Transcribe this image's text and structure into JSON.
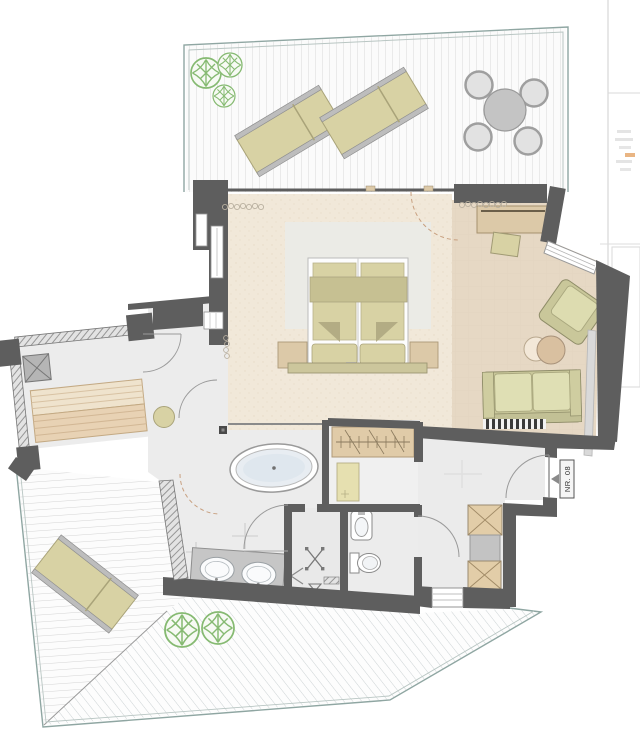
{
  "plan": {
    "room_number_label": "NR. 08",
    "colors": {
      "wall": "#5e5e5e",
      "bedroom_floor": "#f1e8d9",
      "lounge_floor": "#e6d8c4",
      "wet_floor": "#ececec",
      "furniture_khaki": "#d8d2a4",
      "furniture_tan": "#dcc9a8",
      "wood_bench": "#ead9c0",
      "tree_green": "#86ba72",
      "deck_line": "#d8d8d8",
      "border_teal": "#8fa6a2",
      "rug": "#ebebe6",
      "counter_gray": "#c6c6c6",
      "water_blue": "#dfe7ee"
    }
  }
}
